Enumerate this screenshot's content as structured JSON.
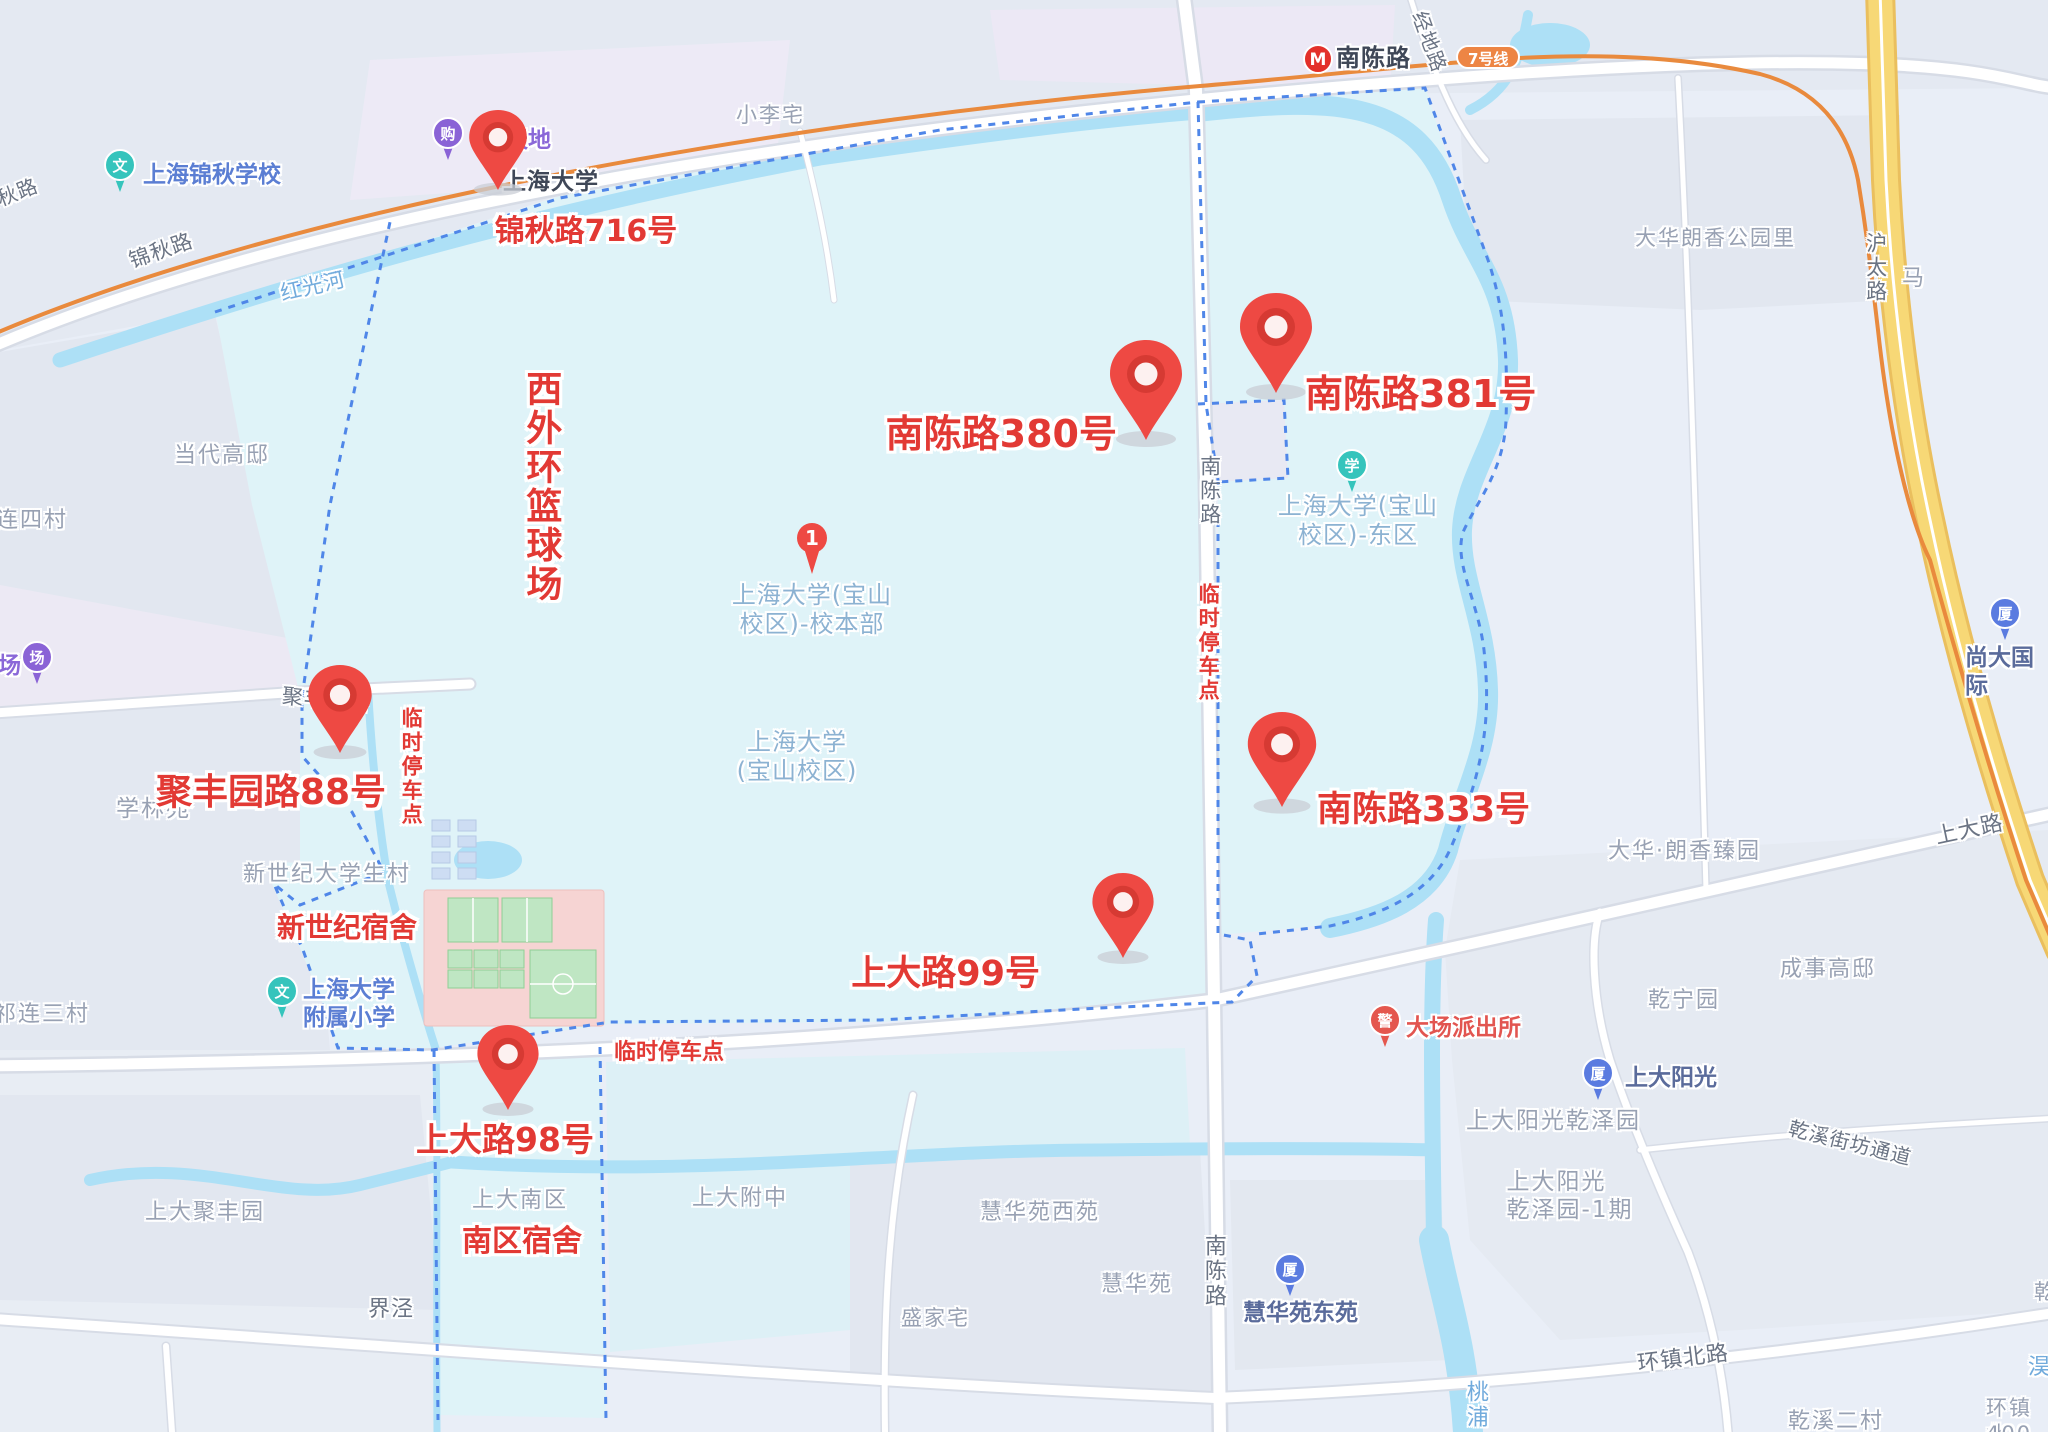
{
  "colors": {
    "annotation_red": "#e23934",
    "pin_red": "#ee4943",
    "campus_fill": "#dff3f8",
    "water_blue": "#ade0f6",
    "boundary_blue": "#4f86e8",
    "metro_line_orange": "#e98a3d",
    "highway_yellow": "#f7d876",
    "line_badge_orange": "#ED8544",
    "poi_teal": "#35c4bc",
    "poi_purple": "#8a63d6",
    "poi_blue": "#5a7be0",
    "poi_police_red": "#e4574e"
  },
  "metro": {
    "badge_label": "7号线"
  },
  "numbered_marker": {
    "number": "1"
  },
  "markers": [
    {
      "label": "锦秋路716号",
      "pin_x": 498,
      "pin_y": 190,
      "scale": 0.8,
      "label_x": 586,
      "label_y": 206,
      "label_anchor": "center",
      "size": 30
    },
    {
      "label": "南陈路380号",
      "pin_x": 1146,
      "pin_y": 440,
      "scale": 1,
      "label_x": 1117,
      "label_y": 403,
      "label_anchor": "end",
      "size": 38
    },
    {
      "label": "南陈路381号",
      "pin_x": 1276,
      "pin_y": 393,
      "scale": 1,
      "label_x": 1305,
      "label_y": 363,
      "label_anchor": "start",
      "size": 38
    },
    {
      "label": "聚丰园路88号",
      "pin_x": 340,
      "pin_y": 753,
      "scale": 0.88,
      "label_x": 271,
      "label_y": 763,
      "label_anchor": "center",
      "size": 36
    },
    {
      "label": "南陈路333号",
      "pin_x": 1282,
      "pin_y": 807,
      "scale": 0.95,
      "label_x": 1317,
      "label_y": 781,
      "label_anchor": "start",
      "size": 35
    },
    {
      "label": "上大路99号",
      "pin_x": 1123,
      "pin_y": 958,
      "scale": 0.85,
      "label_x": 1040,
      "label_y": 945,
      "label_anchor": "end",
      "size": 35
    },
    {
      "label": "上大路98号",
      "pin_x": 508,
      "pin_y": 1110,
      "scale": 0.85,
      "label_x": 505,
      "label_y": 1113,
      "label_anchor": "center",
      "size": 33
    }
  ],
  "annotations": [
    {
      "text": "西外环篮球场",
      "x": 520,
      "y": 370,
      "cls": "v",
      "size": 36
    },
    {
      "text": "新世纪宿舍",
      "x": 277,
      "y": 912,
      "cls": "",
      "size": 28
    },
    {
      "text": "南区宿舍",
      "x": 462,
      "y": 1225,
      "cls": "",
      "size": 30
    },
    {
      "text": "临时停车点",
      "x": 1196,
      "y": 583,
      "cls": "v",
      "size": 21
    },
    {
      "text": "临时停车点",
      "x": 399,
      "y": 707,
      "cls": "v",
      "size": 21
    },
    {
      "text": "临时停车点",
      "x": 614,
      "y": 1040,
      "cls": "",
      "size": 22
    }
  ],
  "labels": [
    {
      "text": "小李宅",
      "x": 736,
      "y": 103,
      "cls": "area",
      "size": 21
    },
    {
      "text": "当代高邸",
      "x": 174,
      "y": 443,
      "cls": "area",
      "size": 22
    },
    {
      "text": "祁连四村",
      "x": -28,
      "y": 508,
      "cls": "area",
      "size": 22
    },
    {
      "text": "学林苑",
      "x": 116,
      "y": 795,
      "cls": "area",
      "size": 23
    },
    {
      "text": "祁连三村",
      "x": -6,
      "y": 1002,
      "cls": "area",
      "size": 22
    },
    {
      "text": "新世纪大学生村",
      "x": 243,
      "y": 862,
      "cls": "area",
      "size": 22
    },
    {
      "text": "上大南区",
      "x": 472,
      "y": 1188,
      "cls": "area",
      "size": 22
    },
    {
      "text": "上大附中",
      "x": 692,
      "y": 1186,
      "cls": "area",
      "size": 22
    },
    {
      "text": "上大聚丰园",
      "x": 145,
      "y": 1200,
      "cls": "area",
      "size": 22
    },
    {
      "text": "盛家宅",
      "x": 901,
      "y": 1306,
      "cls": "area",
      "size": 21
    },
    {
      "text": "慧华苑西苑",
      "x": 980,
      "y": 1200,
      "cls": "area",
      "size": 22
    },
    {
      "text": "慧华苑",
      "x": 1101,
      "y": 1272,
      "cls": "area",
      "size": 22
    },
    {
      "text": "大华朗香公园里",
      "x": 1635,
      "y": 226,
      "cls": "area",
      "size": 21
    },
    {
      "text": "大华·朗香臻园",
      "x": 1608,
      "y": 839,
      "cls": "area",
      "size": 22
    },
    {
      "text": "乾宁园",
      "x": 1648,
      "y": 988,
      "cls": "area",
      "size": 22
    },
    {
      "text": "成事高邸",
      "x": 1780,
      "y": 957,
      "cls": "area",
      "size": 22
    },
    {
      "text": "乾溪二村",
      "x": 1788,
      "y": 1409,
      "cls": "area",
      "size": 22
    },
    {
      "text": "环镇北",
      "x": 1986,
      "y": 1396,
      "cls": "area",
      "size": 21
    },
    {
      "text": "400弄",
      "x": 1986,
      "y": 1422,
      "cls": "area",
      "size": 21
    },
    {
      "text": "马",
      "x": 1902,
      "y": 266,
      "cls": "area",
      "size": 22
    },
    {
      "text": "乾",
      "x": 2034,
      "y": 1280,
      "cls": "area",
      "size": 21
    },
    {
      "text": "上大阳光乾泽园",
      "x": 1466,
      "y": 1107,
      "cls": "area",
      "size": 23
    },
    {
      "text": "上大阳光\n乾泽园-1期",
      "x": 1570,
      "y": 1168,
      "cls": "area",
      "anchor": "center",
      "size": 23
    },
    {
      "text": "锦秋路",
      "x": 126,
      "y": 250,
      "cls": "road",
      "size": 21,
      "rot": -19
    },
    {
      "text": "锦秋路",
      "x": -26,
      "y": 196,
      "cls": "road",
      "size": 20,
      "rot": -21
    },
    {
      "text": "经地路",
      "x": 1430,
      "y": 8,
      "cls": "road",
      "size": 20,
      "rot": 70
    },
    {
      "text": "沪太路",
      "x": 1862,
      "y": 232,
      "cls": "road v",
      "size": 21
    },
    {
      "text": "南陈路",
      "x": 1196,
      "y": 455,
      "cls": "road v",
      "size": 21
    },
    {
      "text": "南陈路",
      "x": 1199,
      "y": 1234,
      "cls": "road v",
      "size": 22
    },
    {
      "text": "聚丰园路",
      "x": 283,
      "y": 684,
      "cls": "road",
      "size": 21,
      "rot": 5
    },
    {
      "text": "上大路",
      "x": 1933,
      "y": 825,
      "cls": "road",
      "size": 22,
      "rot": -12
    },
    {
      "text": "环镇北路",
      "x": 1636,
      "y": 1352,
      "cls": "road",
      "size": 22,
      "rot": -7
    },
    {
      "text": "乾溪街坊通道",
      "x": 1792,
      "y": 1116,
      "cls": "road",
      "size": 20,
      "rot": 14
    },
    {
      "text": "界泾",
      "x": 368,
      "y": 1297,
      "cls": "road",
      "size": 22
    },
    {
      "text": "上海大学",
      "x": 503,
      "y": 168,
      "cls": "station",
      "size": 23
    },
    {
      "text": "南陈路",
      "x": 1336,
      "y": 44,
      "cls": "station",
      "size": 24
    },
    {
      "text": "红光河",
      "x": 278,
      "y": 282,
      "cls": "water",
      "size": 21,
      "rot": -13
    },
    {
      "text": "桃浦",
      "x": 1461,
      "y": 1380,
      "cls": "water v",
      "size": 22
    },
    {
      "text": "淏",
      "x": 2028,
      "y": 1355,
      "cls": "water",
      "size": 22
    },
    {
      "text": "上海大学(宝山\n校区)-校本部",
      "x": 812,
      "y": 581,
      "cls": "campus",
      "anchor": "center",
      "size": 24
    },
    {
      "text": "上海大学\n(宝山校区)",
      "x": 797,
      "y": 728,
      "cls": "campus",
      "anchor": "center",
      "size": 24
    },
    {
      "text": "上海大学(宝山\n校区)-东区",
      "x": 1358,
      "y": 492,
      "cls": "campus",
      "anchor": "center",
      "size": 24
    },
    {
      "text": "上海锦秋学校",
      "x": 143,
      "y": 161,
      "cls": "poi",
      "size": 23
    },
    {
      "text": "上海大学\n附属小学",
      "x": 303,
      "y": 976,
      "cls": "poi",
      "size": 23
    },
    {
      "text": "慧华苑东苑",
      "x": 1243,
      "y": 1299,
      "cls": "poi-dark",
      "size": 23
    },
    {
      "text": "上大阳光",
      "x": 1625,
      "y": 1064,
      "cls": "poi-dark",
      "size": 23
    },
    {
      "text": "尚大国际",
      "x": 1965,
      "y": 644,
      "cls": "poi-dark",
      "size": 23
    },
    {
      "text": "天地",
      "x": 505,
      "y": 126,
      "cls": "purple",
      "size": 23
    },
    {
      "text": "场",
      "x": -2,
      "y": 652,
      "cls": "purple",
      "size": 23
    },
    {
      "text": "大场派出所",
      "x": 1406,
      "y": 1014,
      "cls": "red-poi",
      "size": 23
    }
  ],
  "pois": [
    {
      "icon": "school-icon",
      "glyph": "文",
      "color": "#35c4bc",
      "x": 120,
      "y": 192
    },
    {
      "icon": "school-icon",
      "glyph": "文",
      "color": "#35c4bc",
      "x": 282,
      "y": 1018
    },
    {
      "icon": "campus-east-icon",
      "glyph": "学",
      "color": "#35c4bc",
      "x": 1352,
      "y": 492
    },
    {
      "icon": "shopping-icon",
      "glyph": "购",
      "color": "#8a63d6",
      "x": 448,
      "y": 160
    },
    {
      "icon": "plaza-icon",
      "glyph": "场",
      "color": "#8a63d6",
      "x": 37,
      "y": 684
    },
    {
      "icon": "building-icon",
      "glyph": "厦",
      "color": "#5a7be0",
      "x": 1290,
      "y": 1296
    },
    {
      "icon": "building-icon",
      "glyph": "厦",
      "color": "#5a7be0",
      "x": 1598,
      "y": 1100
    },
    {
      "icon": "building-icon",
      "glyph": "厦",
      "color": "#5a7be0",
      "x": 2005,
      "y": 640
    },
    {
      "icon": "police-icon",
      "glyph": "警",
      "color": "#e4574e",
      "x": 1385,
      "y": 1047
    }
  ]
}
